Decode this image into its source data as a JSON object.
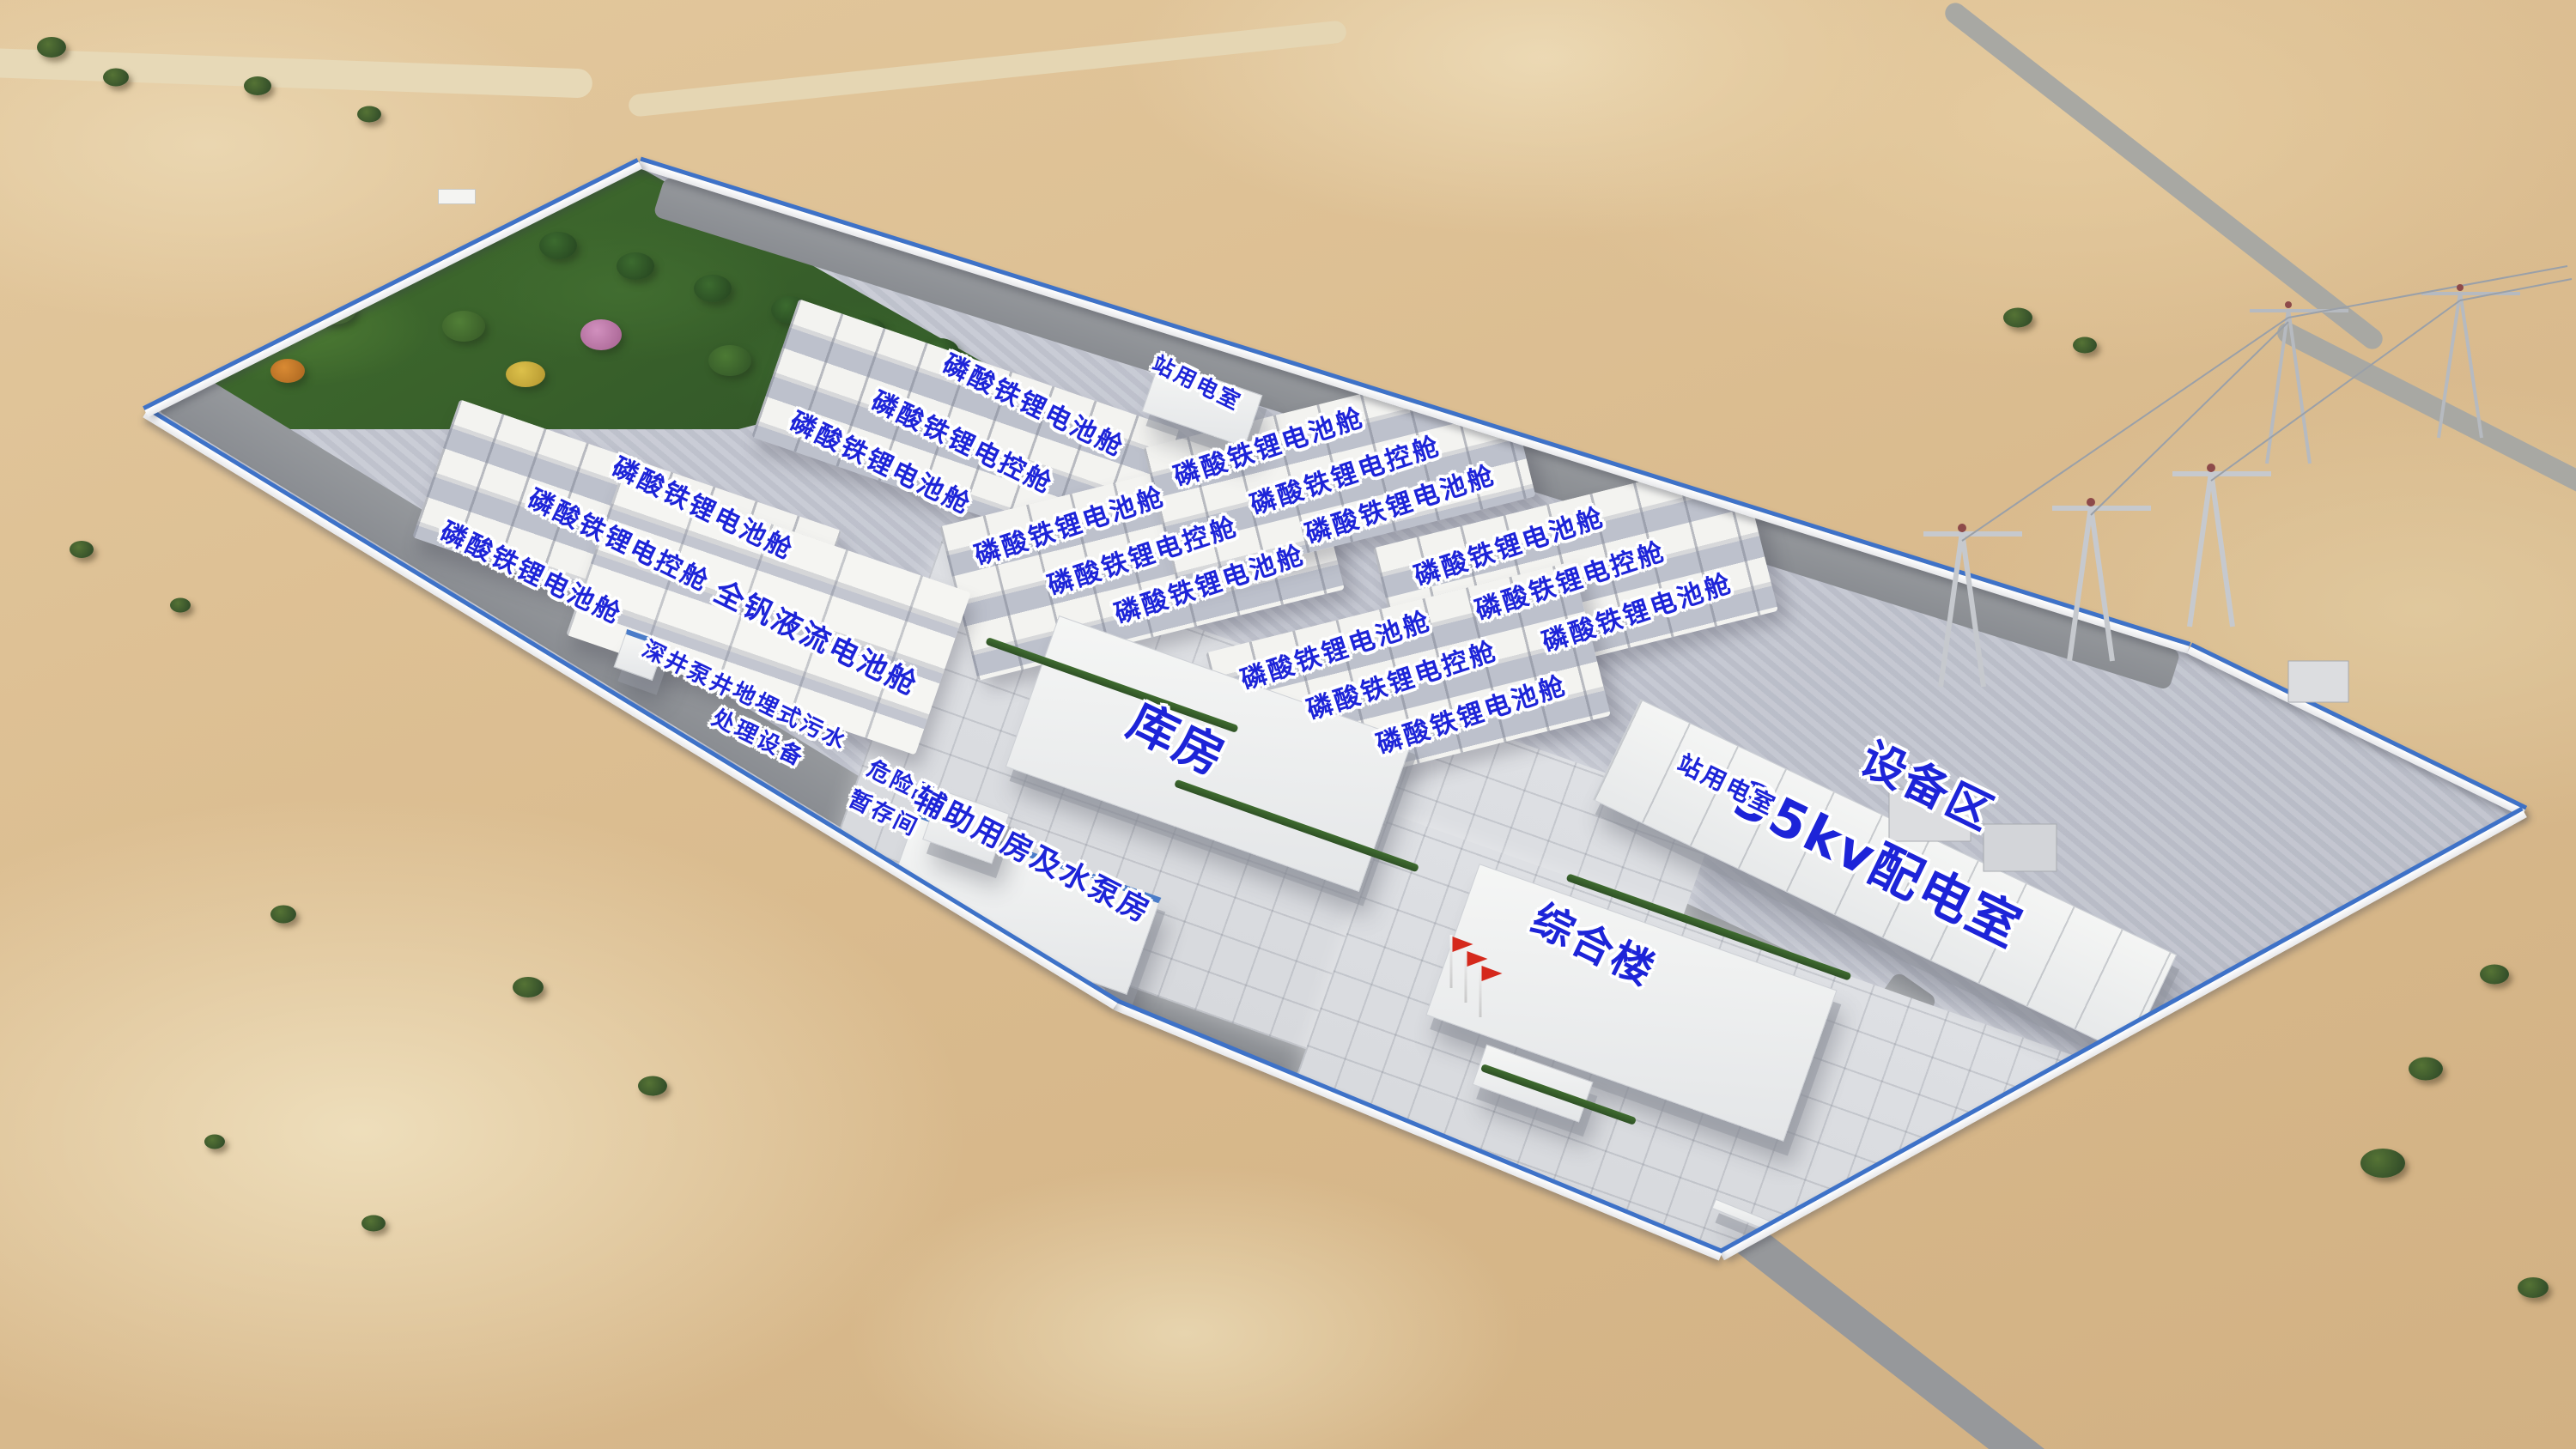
{
  "colors": {
    "label_blue": "#1d24d8",
    "label_halo": "#ffffff",
    "fence_blue": "#3e72c8",
    "flag_red": "#d5291c",
    "desert_sand": "#d9ba8d",
    "gravel_pad": "#c3c6d0",
    "asphalt_road": "#8c8f94",
    "vegetation_green": "#3f7a38",
    "container_white": "#f3f3f0"
  },
  "labels": [
    {
      "text": "站用电室"
    },
    {
      "text": "磷酸铁锂电池舱"
    },
    {
      "text": "磷酸铁锂电控舱"
    },
    {
      "text": "磷酸铁锂电池舱"
    },
    {
      "text": "磷酸铁锂电池舱"
    },
    {
      "text": "磷酸铁锂电控舱"
    },
    {
      "text": "磷酸铁锂电池舱"
    },
    {
      "text": "磷酸铁锂电池舱"
    },
    {
      "text": "磷酸铁锂电控舱"
    },
    {
      "text": "磷酸铁锂电池舱"
    },
    {
      "text": "磷酸铁锂电池舱"
    },
    {
      "text": "磷酸铁锂电控舱"
    },
    {
      "text": "磷酸铁锂电池舱"
    },
    {
      "text": "磷酸铁锂电池舱"
    },
    {
      "text": "磷酸铁锂电控舱"
    },
    {
      "text": "磷酸铁锂电池舱"
    },
    {
      "text": "磷酸铁锂电池舱"
    },
    {
      "text": "磷酸铁锂电控舱"
    },
    {
      "text": "磷酸铁锂电池舱"
    },
    {
      "text": "全钒液流电池舱"
    },
    {
      "text": "深井泵井"
    },
    {
      "text": "地埋式污水"
    },
    {
      "text": "处理设备"
    },
    {
      "text": "危险品"
    },
    {
      "text": "暂存间"
    },
    {
      "text": "库房"
    },
    {
      "text": "辅助用房及水泵房"
    },
    {
      "text": "综合楼"
    },
    {
      "text": "35kv配电室"
    },
    {
      "text": "设备区"
    },
    {
      "text": "站用电室"
    }
  ]
}
